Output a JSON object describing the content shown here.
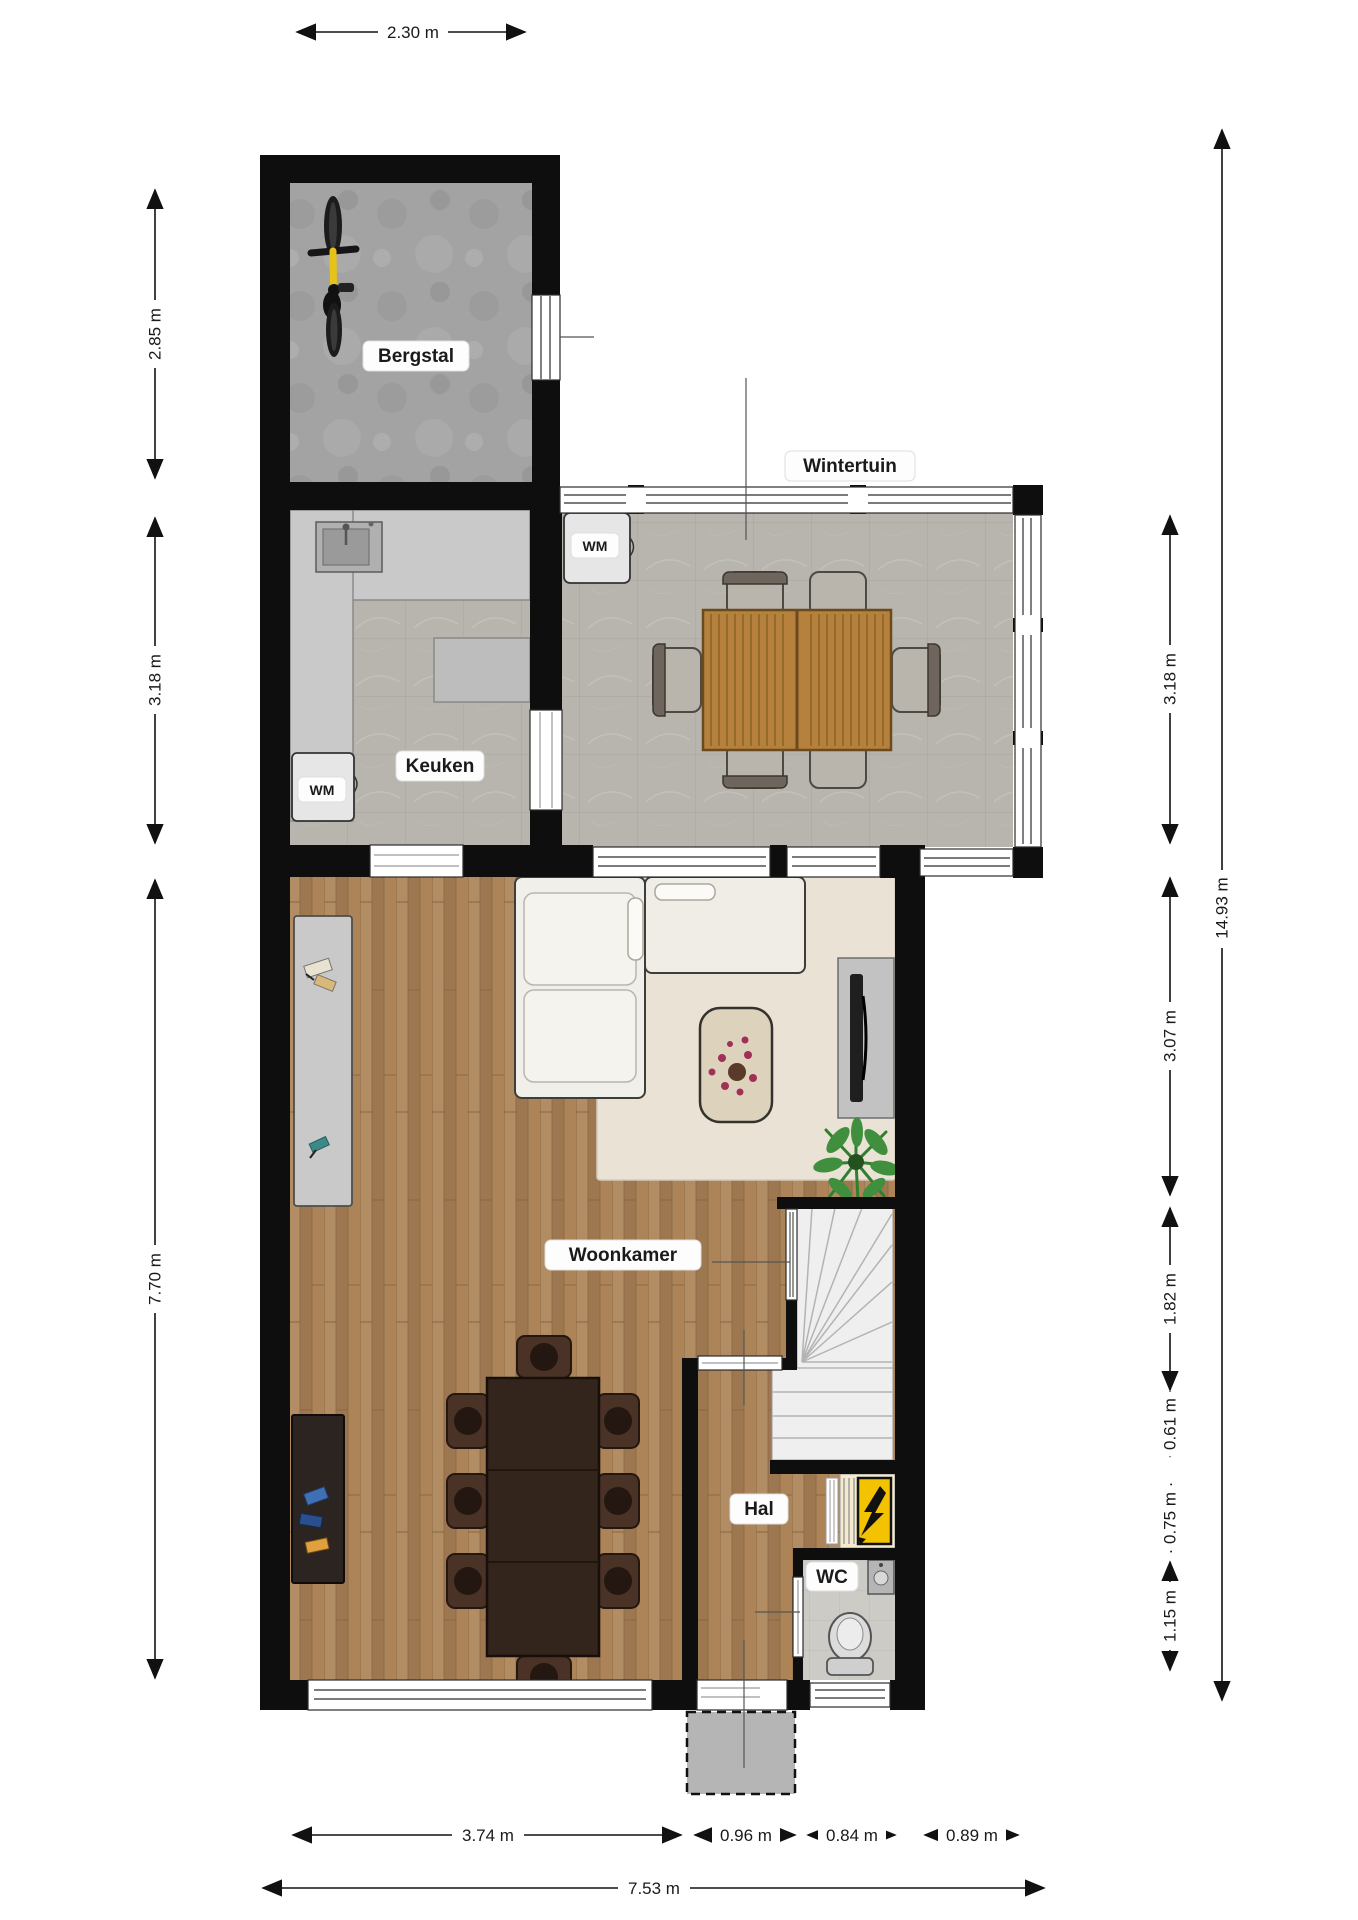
{
  "plan_title": "Begane grond plattegrond",
  "rooms": {
    "bergstal": "Bergstal",
    "wintertuin": "Wintertuin",
    "keuken": "Keuken",
    "woonkamer": "Woonkamer",
    "hal": "Hal",
    "wc": "WC"
  },
  "appliances": {
    "wm_wintertuin": "WM",
    "wm_keuken": "WM"
  },
  "dimensions": {
    "top_width": "2.30 m",
    "left": {
      "bergstal": "2.85 m",
      "keuken": "3.18 m",
      "woonkamer": "7.70 m"
    },
    "right": {
      "wintertuin": "3.18 m",
      "living_upper": "3.07 m",
      "stairs": "1.82 m",
      "meterkast": "0.61 m",
      "mid": "· 0.75 m ·",
      "wc": "1.15 m",
      "total_height": "14.93 m"
    },
    "bottom": {
      "woonkamer": "3.74 m",
      "entrance": "0.96 m",
      "wc": "0.84 m",
      "overhang": "0.89 m",
      "total_width": "7.53 m"
    }
  },
  "colors": {
    "wall": "#0e0e0e",
    "wood_floor": "#a8825c",
    "tile_floor": "#b8b5ae",
    "concrete_floor": "#a3a3a4",
    "rug": "#eae2d4",
    "meterkast_accent": "#f3c200",
    "sofa": "#f1efe9",
    "dining_table_dark": "#33241c",
    "garden_table_wood": "#b5813d",
    "plant_green": "#3f8f3f"
  }
}
